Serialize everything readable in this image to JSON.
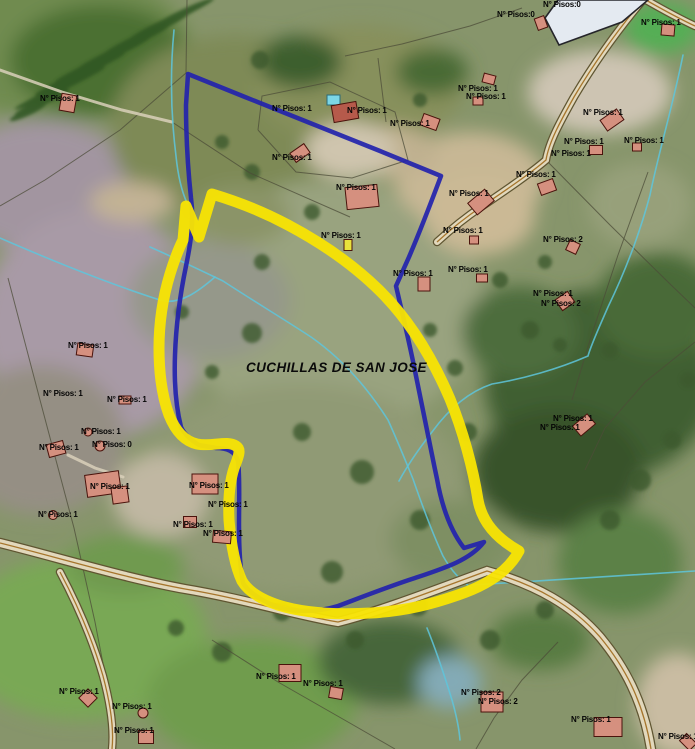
{
  "map": {
    "area_label": {
      "text": "CUCHILLAS DE SAN JOSE",
      "x": 246,
      "y": 372
    },
    "colors": {
      "highlight_boundary": "#f8e403",
      "survey_polygon": "#2323ac",
      "building_fill": "#d5907f",
      "building_outline": "#4a130c",
      "label_color": "#050505",
      "stream": "#5ec6dc",
      "road_fill": "#e2d8bc",
      "road_casing": "#5f5531",
      "road_accent": "#a06a1c",
      "parcel_line": "#4c4c38"
    },
    "floors_labels": [
      {
        "x": 543,
        "y": 5,
        "text": "N° Pisos:0"
      },
      {
        "x": 497,
        "y": 15,
        "text": "N° Pisos:0"
      },
      {
        "x": 641,
        "y": 23,
        "text": "N° Pisos: 1"
      },
      {
        "x": 40,
        "y": 99,
        "text": "N° Pisos: 1"
      },
      {
        "x": 272,
        "y": 109,
        "text": "N° Pisos: 1"
      },
      {
        "x": 347,
        "y": 111,
        "text": "N° Pisos: 1"
      },
      {
        "x": 458,
        "y": 89,
        "text": "N° Pisos: 1"
      },
      {
        "x": 466,
        "y": 97,
        "text": "N° Pisos: 1"
      },
      {
        "x": 390,
        "y": 124,
        "text": "N° Pisos: 1"
      },
      {
        "x": 583,
        "y": 113,
        "text": "N° Pisos: 1"
      },
      {
        "x": 564,
        "y": 142,
        "text": "N° Pisos: 1"
      },
      {
        "x": 624,
        "y": 141,
        "text": "N° Pisos: 1"
      },
      {
        "x": 551,
        "y": 154,
        "text": "N° Pisos: 1"
      },
      {
        "x": 516,
        "y": 175,
        "text": "N° Pisos: 1"
      },
      {
        "x": 272,
        "y": 158,
        "text": "N° Pisos: 1"
      },
      {
        "x": 336,
        "y": 188,
        "text": "N° Pisos: 1"
      },
      {
        "x": 449,
        "y": 194,
        "text": "N° Pisos: 1"
      },
      {
        "x": 321,
        "y": 236,
        "text": "N° Pisos: 1"
      },
      {
        "x": 443,
        "y": 231,
        "text": "N° Pisos: 1"
      },
      {
        "x": 543,
        "y": 240,
        "text": "N° Pisos: 2"
      },
      {
        "x": 393,
        "y": 274,
        "text": "N° Pisos: 1"
      },
      {
        "x": 448,
        "y": 270,
        "text": "N° Pisos: 1"
      },
      {
        "x": 533,
        "y": 294,
        "text": "N° Pisos: 1"
      },
      {
        "x": 541,
        "y": 304,
        "text": "N° Pisos: 2"
      },
      {
        "x": 68,
        "y": 346,
        "text": "N° Pisos: 1"
      },
      {
        "x": 43,
        "y": 394,
        "text": "N° Pisos: 1"
      },
      {
        "x": 107,
        "y": 400,
        "text": "N° Pisos: 1"
      },
      {
        "x": 81,
        "y": 432,
        "text": "N° Pisos: 1"
      },
      {
        "x": 92,
        "y": 445,
        "text": "N° Pisos: 0"
      },
      {
        "x": 39,
        "y": 448,
        "text": "N° Pisos: 1"
      },
      {
        "x": 90,
        "y": 487,
        "text": "N° Pisos: 1"
      },
      {
        "x": 38,
        "y": 515,
        "text": "N° Pisos: 1"
      },
      {
        "x": 189,
        "y": 486,
        "text": "N° Pisos: 1"
      },
      {
        "x": 208,
        "y": 505,
        "text": "N° Pisos: 1"
      },
      {
        "x": 173,
        "y": 525,
        "text": "N° Pisos: 1"
      },
      {
        "x": 203,
        "y": 534,
        "text": "N° Pisos: 1"
      },
      {
        "x": 553,
        "y": 419,
        "text": "N° Pisos: 1"
      },
      {
        "x": 540,
        "y": 428,
        "text": "N° Pisos: 1"
      },
      {
        "x": 59,
        "y": 692,
        "text": "N° Pisos: 1"
      },
      {
        "x": 112,
        "y": 707,
        "text": "N° Pisos: 1"
      },
      {
        "x": 114,
        "y": 731,
        "text": "N° Pisos: 1"
      },
      {
        "x": 256,
        "y": 677,
        "text": "N° Pisos: 1"
      },
      {
        "x": 303,
        "y": 684,
        "text": "N° Pisos: 1"
      },
      {
        "x": 461,
        "y": 693,
        "text": "N° Pisos: 2"
      },
      {
        "x": 478,
        "y": 702,
        "text": "N° Pisos: 2"
      },
      {
        "x": 571,
        "y": 720,
        "text": "N° Pisos: 1"
      },
      {
        "x": 658,
        "y": 737,
        "text": "N° Pisos: 1"
      }
    ],
    "buildings": [
      {
        "x": 68,
        "y": 103,
        "w": 15,
        "h": 17,
        "r": 10
      },
      {
        "x": 345,
        "y": 112,
        "w": 25,
        "h": 17,
        "r": -10,
        "fill": "#b65a4b"
      },
      {
        "x": 430,
        "y": 122,
        "w": 17,
        "h": 12,
        "r": 20
      },
      {
        "x": 300,
        "y": 153,
        "w": 17,
        "h": 11,
        "r": -35
      },
      {
        "x": 362,
        "y": 197,
        "w": 32,
        "h": 22,
        "r": -6
      },
      {
        "x": 489,
        "y": 79,
        "w": 12,
        "h": 9,
        "r": 15
      },
      {
        "x": 478,
        "y": 101,
        "w": 10,
        "h": 8,
        "r": 0
      },
      {
        "x": 612,
        "y": 120,
        "w": 20,
        "h": 13,
        "r": -35
      },
      {
        "x": 668,
        "y": 30,
        "w": 13,
        "h": 11,
        "r": 5
      },
      {
        "x": 541,
        "y": 23,
        "w": 10,
        "h": 12,
        "r": -20
      },
      {
        "x": 596,
        "y": 150,
        "w": 13,
        "h": 9,
        "r": 0
      },
      {
        "x": 637,
        "y": 147,
        "w": 9,
        "h": 8,
        "r": 0
      },
      {
        "x": 547,
        "y": 187,
        "w": 16,
        "h": 12,
        "r": -20
      },
      {
        "x": 348,
        "y": 245,
        "w": 8,
        "h": 11,
        "r": 0,
        "fill": "#e8e23c"
      },
      {
        "x": 424,
        "y": 284,
        "w": 12,
        "h": 14,
        "r": 0
      },
      {
        "x": 481,
        "y": 202,
        "w": 22,
        "h": 15,
        "r": -40
      },
      {
        "x": 474,
        "y": 240,
        "w": 9,
        "h": 8,
        "r": 0
      },
      {
        "x": 482,
        "y": 278,
        "w": 11,
        "h": 8,
        "r": 0
      },
      {
        "x": 573,
        "y": 247,
        "w": 11,
        "h": 11,
        "r": 25
      },
      {
        "x": 565,
        "y": 301,
        "w": 15,
        "h": 13,
        "r": -35
      },
      {
        "x": 85,
        "y": 350,
        "w": 16,
        "h": 12,
        "r": 8
      },
      {
        "x": 125,
        "y": 400,
        "w": 12,
        "h": 8,
        "r": 0
      },
      {
        "x": 88,
        "y": 432,
        "w": 8,
        "h": 8,
        "r": 0,
        "shape": "circle"
      },
      {
        "x": 100,
        "y": 446,
        "w": 10,
        "h": 10,
        "r": 0,
        "shape": "circle"
      },
      {
        "x": 56,
        "y": 449,
        "w": 17,
        "h": 13,
        "r": -15
      },
      {
        "x": 103,
        "y": 484,
        "w": 34,
        "h": 22,
        "r": -8
      },
      {
        "x": 120,
        "y": 495,
        "w": 16,
        "h": 16,
        "r": -8
      },
      {
        "x": 53,
        "y": 515,
        "w": 9,
        "h": 9,
        "r": 0,
        "shape": "circle"
      },
      {
        "x": 205,
        "y": 484,
        "w": 26,
        "h": 20,
        "r": 0
      },
      {
        "x": 190,
        "y": 522,
        "w": 13,
        "h": 11,
        "r": 0
      },
      {
        "x": 222,
        "y": 537,
        "w": 18,
        "h": 12,
        "r": 5
      },
      {
        "x": 584,
        "y": 425,
        "w": 19,
        "h": 13,
        "r": -40
      },
      {
        "x": 88,
        "y": 698,
        "w": 13,
        "h": 13,
        "r": 45
      },
      {
        "x": 143,
        "y": 713,
        "w": 10,
        "h": 10,
        "r": 0,
        "shape": "circle"
      },
      {
        "x": 146,
        "y": 737,
        "w": 15,
        "h": 13,
        "r": 0
      },
      {
        "x": 290,
        "y": 673,
        "w": 22,
        "h": 17,
        "r": 0
      },
      {
        "x": 336,
        "y": 693,
        "w": 13,
        "h": 11,
        "r": 10
      },
      {
        "x": 492,
        "y": 702,
        "w": 22,
        "h": 20,
        "r": 0
      },
      {
        "x": 608,
        "y": 727,
        "w": 28,
        "h": 19,
        "r": 0
      },
      {
        "x": 688,
        "y": 742,
        "w": 14,
        "h": 10,
        "r": 45
      }
    ],
    "structures": [
      {
        "type": "poly",
        "points": "558,0 648,0 622,22 559,45 545,18",
        "fill": "#e4eaf1",
        "stroke": "#25252a"
      },
      {
        "type": "rect",
        "x": 327,
        "y": 95,
        "w": 13,
        "h": 10,
        "fill": "#7cd6e6",
        "stroke": "#2a6a78"
      }
    ],
    "boundaries": {
      "yellow_path": "M 212,194 C 232,200 260,210 288,225 C 320,242 353,264 381,292 C 409,320 432,357 450,399 C 463,431 473,468 478,500 C 482,522 496,538 519,551 C 509,570 488,585 458,595 C 432,604 406,611 371,613 C 336,615 303,613 278,605 C 260,599 248,591 242,581 C 235,566 231,545 229,520 C 228,497 230,477 236,463 C 239,455 241,449 236,446 C 227,440 212,447 197,444 C 184,441 175,430 169,415 C 162,396 159,372 159,348 C 159,322 163,297 170,274 C 174,261 178,250 183,240 L 186,206 L 199,237 Z",
      "blue_path": "M 188,74 L 245,97 L 310,123 L 380,151 L 441,176 C 432,200 421,229 409,257 L 396,286 C 402,312 409,341 415,371 C 421,402 429,441 437,479 C 442,507 450,530 464,548 L 484,542 C 470,560 445,568 415,578 C 390,586 362,597 338,606 C 315,613 290,613 270,604 C 256,597 247,590 243,583 C 240,568 239,548 239,525 C 239,500 240,478 238,461 C 235,451 227,448 216,448 L 199,445 C 191,440 184,434 181,427 C 176,407 174,382 175,355 C 176,325 180,295 186,266 C 191,242 194,220 191,198 C 188,170 186,135 186,105 Z"
    },
    "roads": [
      {
        "d": "M 0,543 C 60,558 125,578 185,589 C 245,599 300,616 338,622 C 385,610 440,588 487,571 C 537,585 573,606 600,637 C 624,666 643,700 651,749",
        "w": 8
      },
      {
        "d": "M 60,572 C 76,602 92,638 103,676 C 111,706 114,730 112,749",
        "w": 6
      },
      {
        "d": "M 643,0 C 621,26 596,60 574,97 C 560,122 549,142 546,160 C 531,173 506,190 481,207 C 463,219 449,231 437,242",
        "w": 6
      },
      {
        "d": "M 646,0 C 660,8 678,18 695,26",
        "w": 6
      }
    ],
    "tracks": [
      "M 0,70 L 62,92 L 122,110 L 172,122",
      "M 68,455 L 95,468 L 123,477"
    ],
    "streams": [
      "M 683,55 C 673,105 658,155 650,195 C 638,240 622,278 608,307 C 598,330 591,345 588,356 C 558,369 523,379 492,384 C 468,392 448,410 432,432 C 418,450 406,468 399,481",
      "M 150,247 C 175,258 200,270 223,281 C 252,300 282,318 311,337 C 341,358 367,387 388,420 C 398,442 406,462 413,479 C 422,505 432,532 443,556 C 452,572 462,582 472,588",
      "M 174,30 C 170,72 171,116 176,156 C 178,176 182,192 187,203",
      "M 0,238 C 55,262 110,284 160,300 C 180,306 200,290 215,277",
      "M 473,585 L 695,571",
      "M 427,628 C 436,650 444,674 452,700 C 456,714 459,728 460,740"
    ],
    "parcel_lines": [
      "M 187,0 L 186,73",
      "M 186,73 L 120,130 L 45,180 L 0,206",
      "M 172,122 L 250,173 L 350,217",
      "M 258,130 L 262,96 L 330,82 L 395,112 L 408,160 L 352,178 L 296,172 L 258,130",
      "M 345,56 L 402,44 L 470,26 L 522,8",
      "M 378,58 L 386,122",
      "M 546,160 L 610,225 L 668,282 L 695,308",
      "M 648,172 L 618,255 L 590,340 L 572,400",
      "M 8,278 L 40,400 L 74,528 L 95,622 L 110,700 L 114,749",
      "M 212,640 L 278,682 L 348,722 L 395,749",
      "M 558,642 L 522,680 L 494,718 L 476,749",
      "M 695,342 L 645,382 L 605,428 L 585,470"
    ]
  }
}
